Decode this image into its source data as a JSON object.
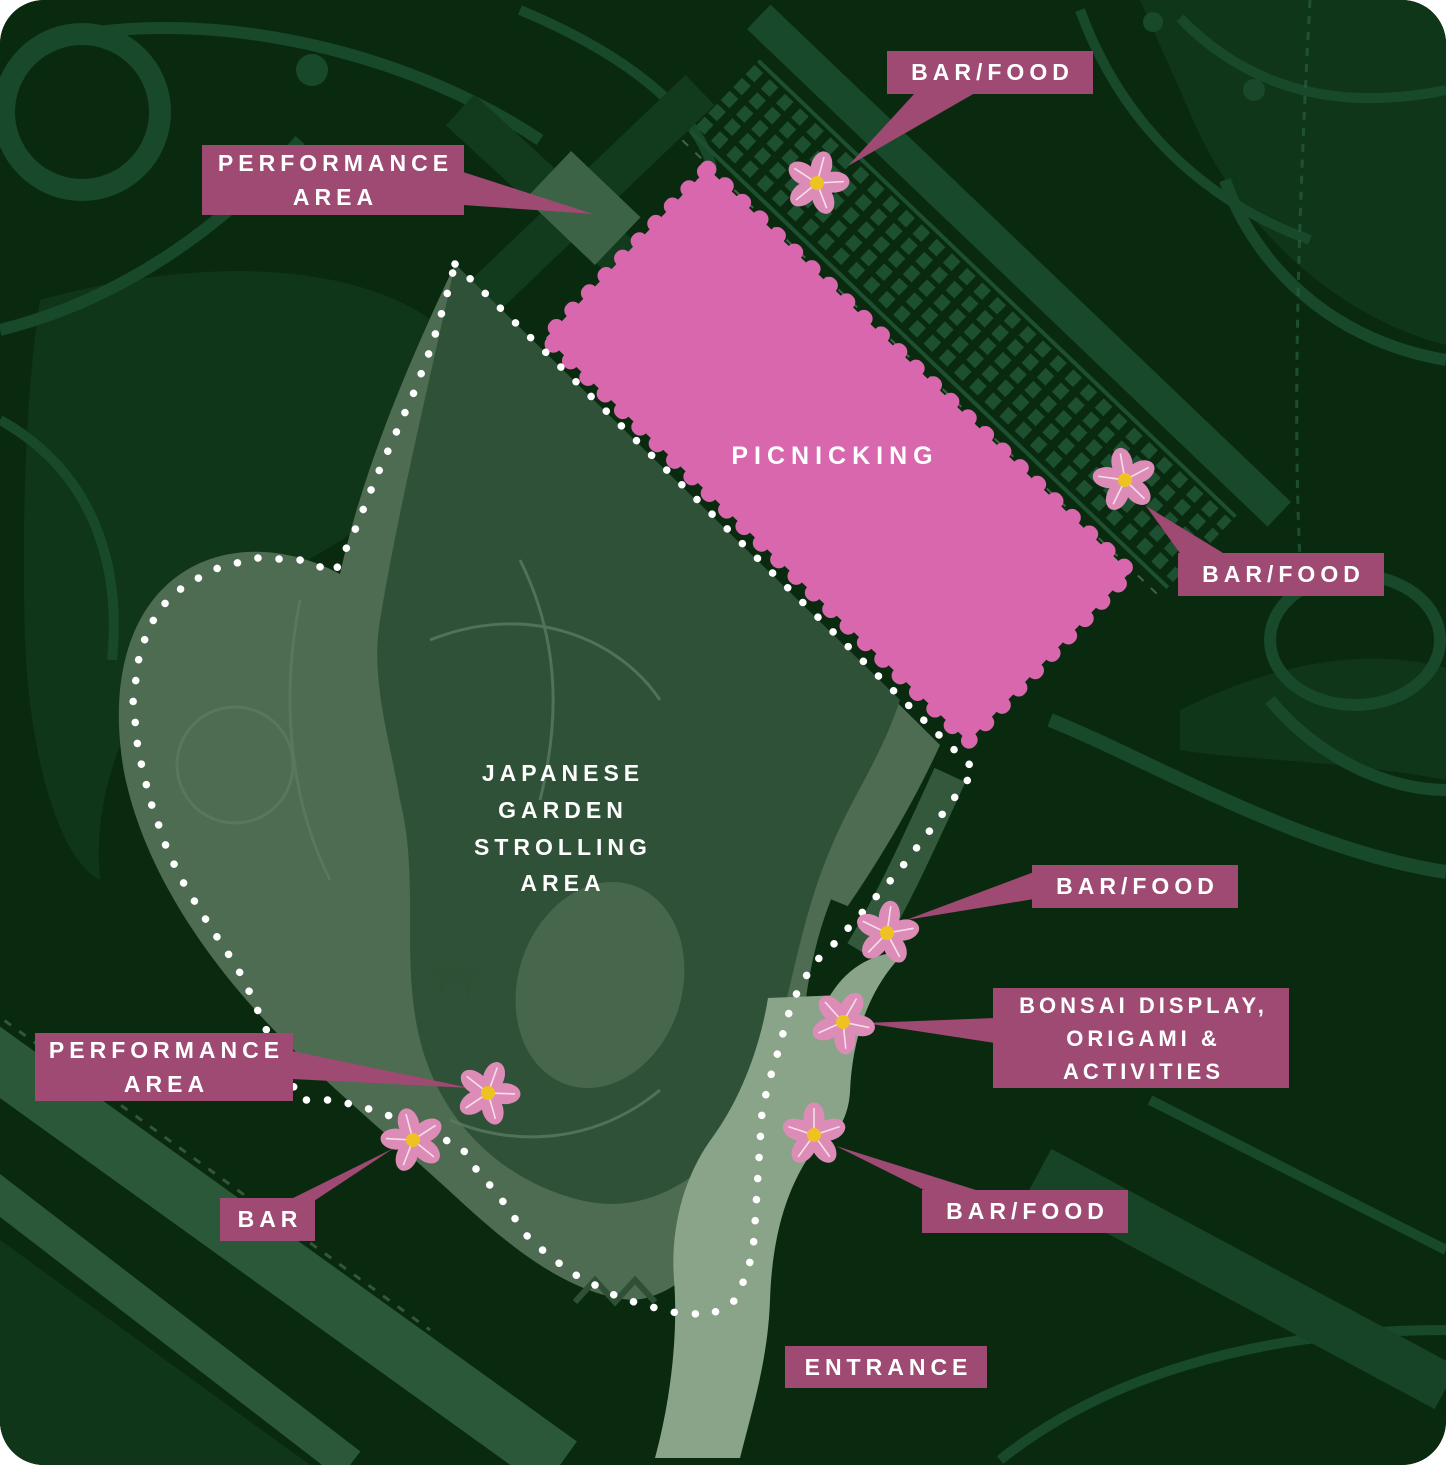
{
  "map": {
    "kind": "festival-park-map",
    "areas": {
      "picnicking": {
        "label": "PICNICKING"
      },
      "japanese_garden": {
        "lines": [
          "JAPANESE",
          "GARDEN",
          "STROLLING",
          "AREA"
        ]
      }
    },
    "labels": {
      "performance_top": {
        "lines": [
          "PERFORMANCE",
          "AREA"
        ]
      },
      "bar_food_top": {
        "lines": [
          "BAR/FOOD"
        ]
      },
      "bar_food_right": {
        "lines": [
          "BAR/FOOD"
        ]
      },
      "bar_food_mid": {
        "lines": [
          "BAR/FOOD"
        ]
      },
      "bonsai": {
        "lines": [
          "BONSAI DISPLAY,",
          "ORIGAMI &",
          "ACTIVITIES"
        ]
      },
      "bar_food_bottom": {
        "lines": [
          "BAR/FOOD"
        ]
      },
      "performance_bottom": {
        "lines": [
          "PERFORMANCE",
          "AREA"
        ]
      },
      "bar": {
        "lines": [
          "BAR"
        ]
      },
      "entrance": {
        "lines": [
          "ENTRANCE"
        ]
      }
    },
    "markers": {
      "icon": "cherry-blossom",
      "count": 7,
      "marks": [
        "bar/food north",
        "bar/food east",
        "bar/food middle",
        "bonsai display & activities",
        "bar/food south",
        "performance area south",
        "bar south"
      ]
    },
    "colors": {
      "background": "#0a2a10",
      "paths": "#17492a",
      "garden": "#4d6c51",
      "garden_inner": "#2e5137",
      "picnic_pink": "#d867ad",
      "blossom_pink": "#dd8cb8",
      "blossom_center": "#eec223",
      "label_magenta": "#9e4a73",
      "entrance_path": "#8aa489",
      "boundary_dots": "#ffffff"
    }
  }
}
